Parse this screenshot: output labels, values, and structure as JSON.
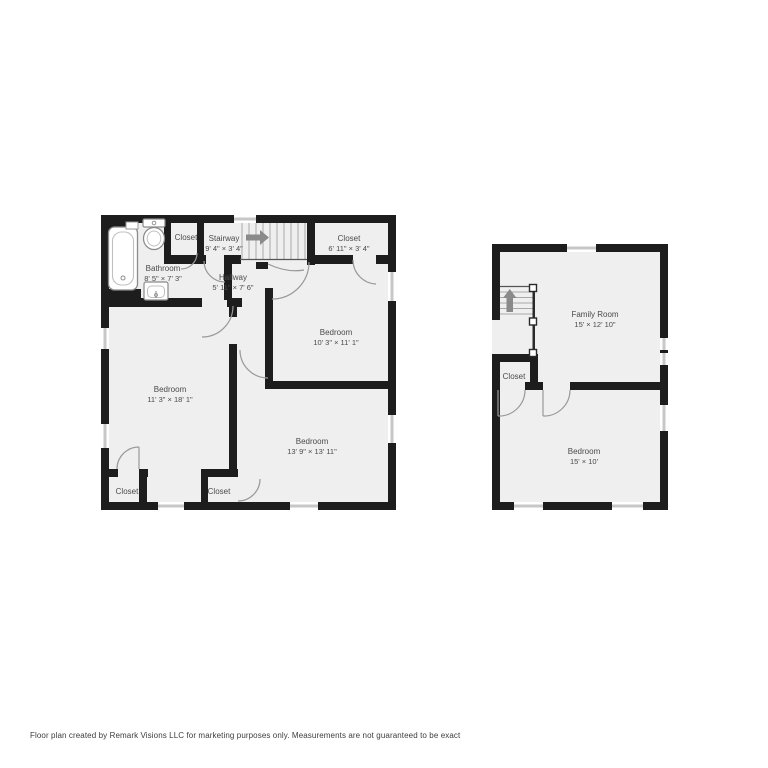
{
  "footer": {
    "text": "Floor plan created by Remark Visions LLC for marketing purposes only. Measurements are not guaranteed to be exact"
  },
  "colors": {
    "background": "#ffffff",
    "wall": "#1d1d1d",
    "room_fill": "#efefef",
    "window": "#c7c7c7",
    "label": "#4a4a4a",
    "door_arc": "#999999",
    "stair_arrow": "#8a8a8a"
  },
  "floors": [
    {
      "id": "floor-plan-left",
      "rooms": [
        {
          "name": "Closet",
          "dims": ""
        },
        {
          "name": "Stairway",
          "dims": "9' 4\" × 3' 4\""
        },
        {
          "name": "Closet",
          "dims": "6' 11\" × 3' 4\""
        },
        {
          "name": "Bathroom",
          "dims": "8' 5\" × 7' 3\""
        },
        {
          "name": "Hallway",
          "dims": "5' 11\" × 7' 6\""
        },
        {
          "name": "Bedroom",
          "dims": "10' 3\" × 11' 1\""
        },
        {
          "name": "Bedroom",
          "dims": "11' 3\" × 18' 1\""
        },
        {
          "name": "Bedroom",
          "dims": "13' 9\" × 13' 11\""
        },
        {
          "name": "Closet",
          "dims": ""
        },
        {
          "name": "Closet",
          "dims": ""
        }
      ]
    },
    {
      "id": "floor-plan-right",
      "rooms": [
        {
          "name": "Family Room",
          "dims": "15' × 12' 10\""
        },
        {
          "name": "Closet",
          "dims": ""
        },
        {
          "name": "Bedroom",
          "dims": "15' × 10'"
        }
      ]
    }
  ]
}
